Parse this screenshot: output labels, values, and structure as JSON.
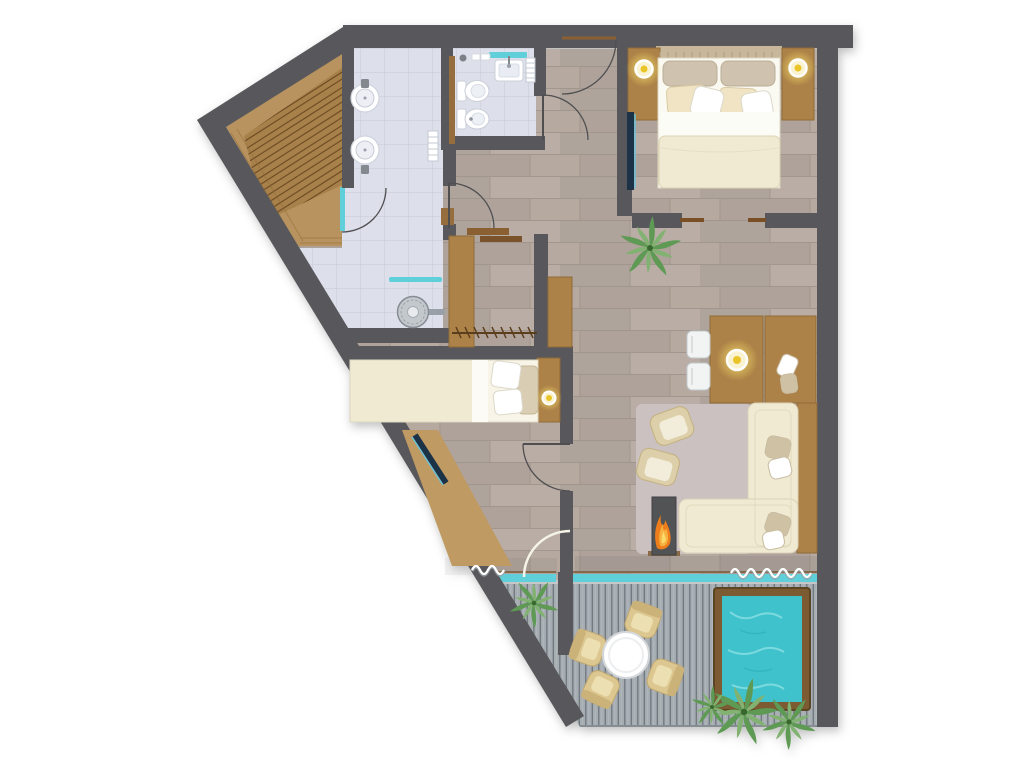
{
  "meta": {
    "title": "Suite floor plan",
    "description": "Top-down architectural floor plan: sauna, bathroom with twin basins and shower, WC, walk-in closet, master bedroom, second bedroom, living-dining room with fireplace, and terrace with plunge pool",
    "visible_text_in_image": "none"
  },
  "colors": {
    "wall": "#58595b",
    "floor_wood": "#b5a9a0",
    "tile": "#dde0ea",
    "sauna_wood": "#b8935e",
    "slat_wood": "#a8804a",
    "furniture_wood": "#ad8248",
    "deck": "#a6adb2",
    "pool_water": "#41c2cc",
    "pool_frame": "#7b5a33",
    "glass_teal": "#5fd0da",
    "lamp_yellow": "#e9c52c",
    "fire_orange": "#ee7d1c",
    "plant_green": "#5f9a55",
    "plant_green_light": "#82b271",
    "sofa_cream": "#f1ead2",
    "rug": "#cbc1c1",
    "tv_navy": "#1f3346",
    "fixture_white": "#ffffff",
    "door_stroke": "#4f4f51",
    "curtain_white": "#ffffff"
  },
  "rooms": [
    {
      "id": "sauna",
      "label": "sauna",
      "floor": "wood-slats"
    },
    {
      "id": "bathroom",
      "label": "bathroom",
      "floor": "tiles"
    },
    {
      "id": "wc",
      "label": "wc",
      "floor": "tiles"
    },
    {
      "id": "hallway",
      "label": "entry-hallway",
      "floor": "wood"
    },
    {
      "id": "closet",
      "label": "walk-in-closet",
      "floor": "wood"
    },
    {
      "id": "bedroom-master",
      "label": "master-bedroom",
      "floor": "wood"
    },
    {
      "id": "bedroom-second",
      "label": "second-bedroom",
      "floor": "wood"
    },
    {
      "id": "living",
      "label": "living-dining-room",
      "floor": "wood"
    },
    {
      "id": "terrace",
      "label": "terrace",
      "floor": "decking"
    }
  ],
  "furniture": {
    "sauna": [
      "tiered-wood-benches"
    ],
    "bathroom": [
      "twin-round-washbasins",
      "walk-in-shower",
      "glass-screen",
      "towel-radiator",
      "mirror-strips",
      "glass-door"
    ],
    "wc": [
      "toilet",
      "bidet",
      "washbasin",
      "towel-radiator",
      "window"
    ],
    "closet": [
      "wardrobe-cabinet",
      "clothes-rail-with-hangers",
      "wardrobe-shelf"
    ],
    "master_bedroom": [
      "double-bed",
      "headboard",
      "two-nightstands",
      "two-bedside-lamps",
      "wall-mounted-tv",
      "sliding-door",
      "plant"
    ],
    "second_bedroom": [
      "single-bed",
      "bedside-lamp",
      "wall-mounted-tv",
      "slat-bench",
      "terrace-door"
    ],
    "living_dining": [
      "dining-table",
      "pendant-lamp",
      "two-white-chairs",
      "desk-sideboard",
      "wall-console",
      "l-shaped-sofa",
      "throw-pillows",
      "two-armchairs",
      "coffee-table-set",
      "rug",
      "log-burner-fireplace",
      "curtains",
      "picture-window"
    ],
    "terrace": [
      "wood-decking",
      "round-table",
      "four-outdoor-chairs",
      "plunge-pool",
      "potted-plants"
    ]
  }
}
